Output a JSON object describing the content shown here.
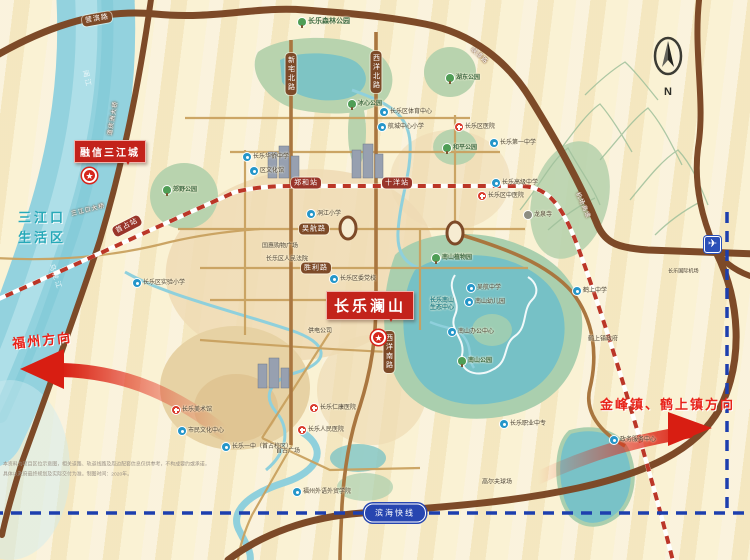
{
  "project": {
    "name": "长乐澜山",
    "secondary_name": "融信三江城",
    "star_glyph": "★"
  },
  "compass": {
    "north_label": "N"
  },
  "airport": {
    "glyph": "✈",
    "name": "长乐国际机场"
  },
  "transit": {
    "binhai_line": "滨海快线"
  },
  "colors": {
    "accent_red": "#d6261c",
    "road_dark": "#7d4a28",
    "road_tan": "#a9763f",
    "water": "#93d2de",
    "lake_teal": "#76c1c6",
    "park_green": "#b8d3ae",
    "metro_red": "#bb3627",
    "binhai_blue": "#1d3fae",
    "cream": "#f7eccb"
  },
  "map": {
    "capsules": [
      {
        "k": "road",
        "dir": "v",
        "x": 291,
        "y": 74,
        "t": "新宅北路"
      },
      {
        "k": "road",
        "dir": "v",
        "x": 376,
        "y": 72,
        "t": "西洋北路"
      },
      {
        "k": "road",
        "dir": "v",
        "x": 389,
        "y": 352,
        "t": "西洋南路"
      },
      {
        "k": "road",
        "dir": "h",
        "x": 314,
        "y": 229,
        "t": "吴航路"
      },
      {
        "k": "road",
        "dir": "h",
        "x": 316,
        "y": 268,
        "t": "胜利路"
      },
      {
        "k": "road",
        "dir": "h",
        "x": 97,
        "y": 19,
        "rot": -10,
        "t": "营滨路"
      },
      {
        "k": "station",
        "dir": "h",
        "x": 306,
        "y": 183,
        "t": "郑和站"
      },
      {
        "k": "station",
        "dir": "h",
        "x": 397,
        "y": 183,
        "t": "十洋站"
      },
      {
        "k": "station",
        "dir": "h",
        "x": 127,
        "y": 226,
        "rot": -27,
        "t": "首占站"
      }
    ],
    "onroad": [
      {
        "x": 480,
        "y": 55,
        "rot": 42,
        "t": "峡漳路"
      },
      {
        "x": 584,
        "y": 205,
        "rot": 66,
        "t": "机场高速"
      },
      {
        "x": 88,
        "y": 209,
        "rot": -14,
        "t": "三江口大桥"
      },
      {
        "x": 112,
        "y": 118,
        "rot": -80,
        "t": "道庆洲大桥"
      }
    ],
    "pois": [
      {
        "icon": "tree",
        "x": 298,
        "y": 22,
        "cls": "park big",
        "t": "长乐森林公园"
      },
      {
        "icon": "tree",
        "x": 446,
        "y": 78,
        "cls": "park",
        "t": "湖东公园"
      },
      {
        "icon": "tree",
        "x": 163,
        "y": 190,
        "cls": "park",
        "t": "郊野公园"
      },
      {
        "icon": "tree",
        "x": 348,
        "y": 104,
        "cls": "park",
        "t": "冰心公园"
      },
      {
        "icon": "tree",
        "x": 443,
        "y": 148,
        "cls": "park",
        "t": "和平公园"
      },
      {
        "icon": "tree",
        "x": 432,
        "y": 258,
        "cls": "park",
        "t": "南山植物园"
      },
      {
        "icon": "tree",
        "x": 458,
        "y": 361,
        "cls": "park",
        "t": "南山公园"
      },
      {
        "icon": "school",
        "x": 243,
        "y": 157,
        "t": "长乐华侨中学"
      },
      {
        "icon": "school",
        "x": 250,
        "y": 171,
        "t": "区文化馆"
      },
      {
        "icon": "school",
        "x": 307,
        "y": 214,
        "t": "洞江小学"
      },
      {
        "icon": "school",
        "x": 330,
        "y": 279,
        "t": "长乐区委党校"
      },
      {
        "icon": "school",
        "x": 380,
        "y": 112,
        "t": "长乐区体育中心"
      },
      {
        "icon": "school",
        "x": 378,
        "y": 127,
        "t": "航城中心小学"
      },
      {
        "icon": "school",
        "x": 490,
        "y": 143,
        "t": "长乐第一中学"
      },
      {
        "icon": "school",
        "x": 492,
        "y": 183,
        "t": "长乐高级中学"
      },
      {
        "icon": "school",
        "x": 467,
        "y": 288,
        "t": "吴航中学"
      },
      {
        "icon": "school",
        "x": 465,
        "y": 302,
        "t": "南山幼儿园"
      },
      {
        "icon": "school",
        "x": 448,
        "y": 332,
        "t": "南山办公中心"
      },
      {
        "icon": "school",
        "x": 573,
        "y": 291,
        "t": "鹤上中学"
      },
      {
        "icon": "school",
        "x": 178,
        "y": 431,
        "t": "市民文化中心"
      },
      {
        "icon": "school",
        "x": 222,
        "y": 447,
        "t": "长乐一中（首占校区）"
      },
      {
        "icon": "school",
        "x": 293,
        "y": 492,
        "t": "福州外语外贸学院"
      },
      {
        "icon": "school",
        "x": 500,
        "y": 424,
        "t": "长乐职业中专"
      },
      {
        "icon": "school",
        "x": 610,
        "y": 440,
        "t": "政务服务中心"
      },
      {
        "icon": "school",
        "x": 133,
        "y": 283,
        "t": "长乐区实验小学"
      },
      {
        "icon": "hospital",
        "x": 455,
        "y": 127,
        "t": "长乐区医院"
      },
      {
        "icon": "hospital",
        "x": 478,
        "y": 196,
        "t": "长乐区中医院"
      },
      {
        "icon": "hospital",
        "x": 310,
        "y": 408,
        "t": "长乐仁康医院"
      },
      {
        "icon": "hospital",
        "x": 298,
        "y": 430,
        "t": "长乐人民医院"
      },
      {
        "icon": "hospital",
        "x": 172,
        "y": 410,
        "t": "长乐美术馆"
      },
      {
        "icon": "temple",
        "x": 524,
        "y": 215,
        "t": "龙泉寺"
      },
      {
        "icon": "none",
        "x": 262,
        "y": 247,
        "t": "国惠购物广场"
      },
      {
        "icon": "none",
        "x": 266,
        "y": 260,
        "t": "长乐区人民法院"
      },
      {
        "icon": "none",
        "x": 276,
        "y": 452,
        "t": "首占广场"
      },
      {
        "icon": "none",
        "x": 588,
        "y": 340,
        "t": "鹤上镇政府"
      },
      {
        "icon": "none",
        "x": 482,
        "y": 483,
        "t": "高尔夫球场"
      },
      {
        "icon": "none",
        "x": 308,
        "y": 332,
        "t": "供电公司"
      },
      {
        "icon": "none",
        "x": 430,
        "y": 305,
        "cls": "lake",
        "t": "长乐南山\n生态中心"
      }
    ],
    "texts": [
      {
        "cls": "t-district",
        "x": 18,
        "y": 208,
        "t": "三江口\n生活区"
      },
      {
        "cls": "t-dir",
        "x": 12,
        "y": 330,
        "rot": -6,
        "t": "福州方向"
      },
      {
        "cls": "t-dir",
        "x": 600,
        "y": 394,
        "t": "金峰镇、鹤上镇方向"
      },
      {
        "cls": "t-water",
        "x": 78,
        "y": 74,
        "rot": 78,
        "t": "闽江"
      },
      {
        "cls": "t-water",
        "x": 42,
        "y": 272,
        "rot": 72,
        "t": "乌龙江"
      },
      {
        "cls": "t-tiny",
        "x": 668,
        "y": 266,
        "t": "长乐国际机场"
      },
      {
        "cls": "t-small",
        "x": 3,
        "y": 460,
        "t": "本资料为项目区位示意图，相关道路、轨道线路及周边配套信息仅供参考，不构成要约或承诺，"
      },
      {
        "cls": "t-small",
        "x": 3,
        "y": 470,
        "t": "具体以政府最终规划及实际交付为准。制图时间：2020年。"
      }
    ]
  }
}
